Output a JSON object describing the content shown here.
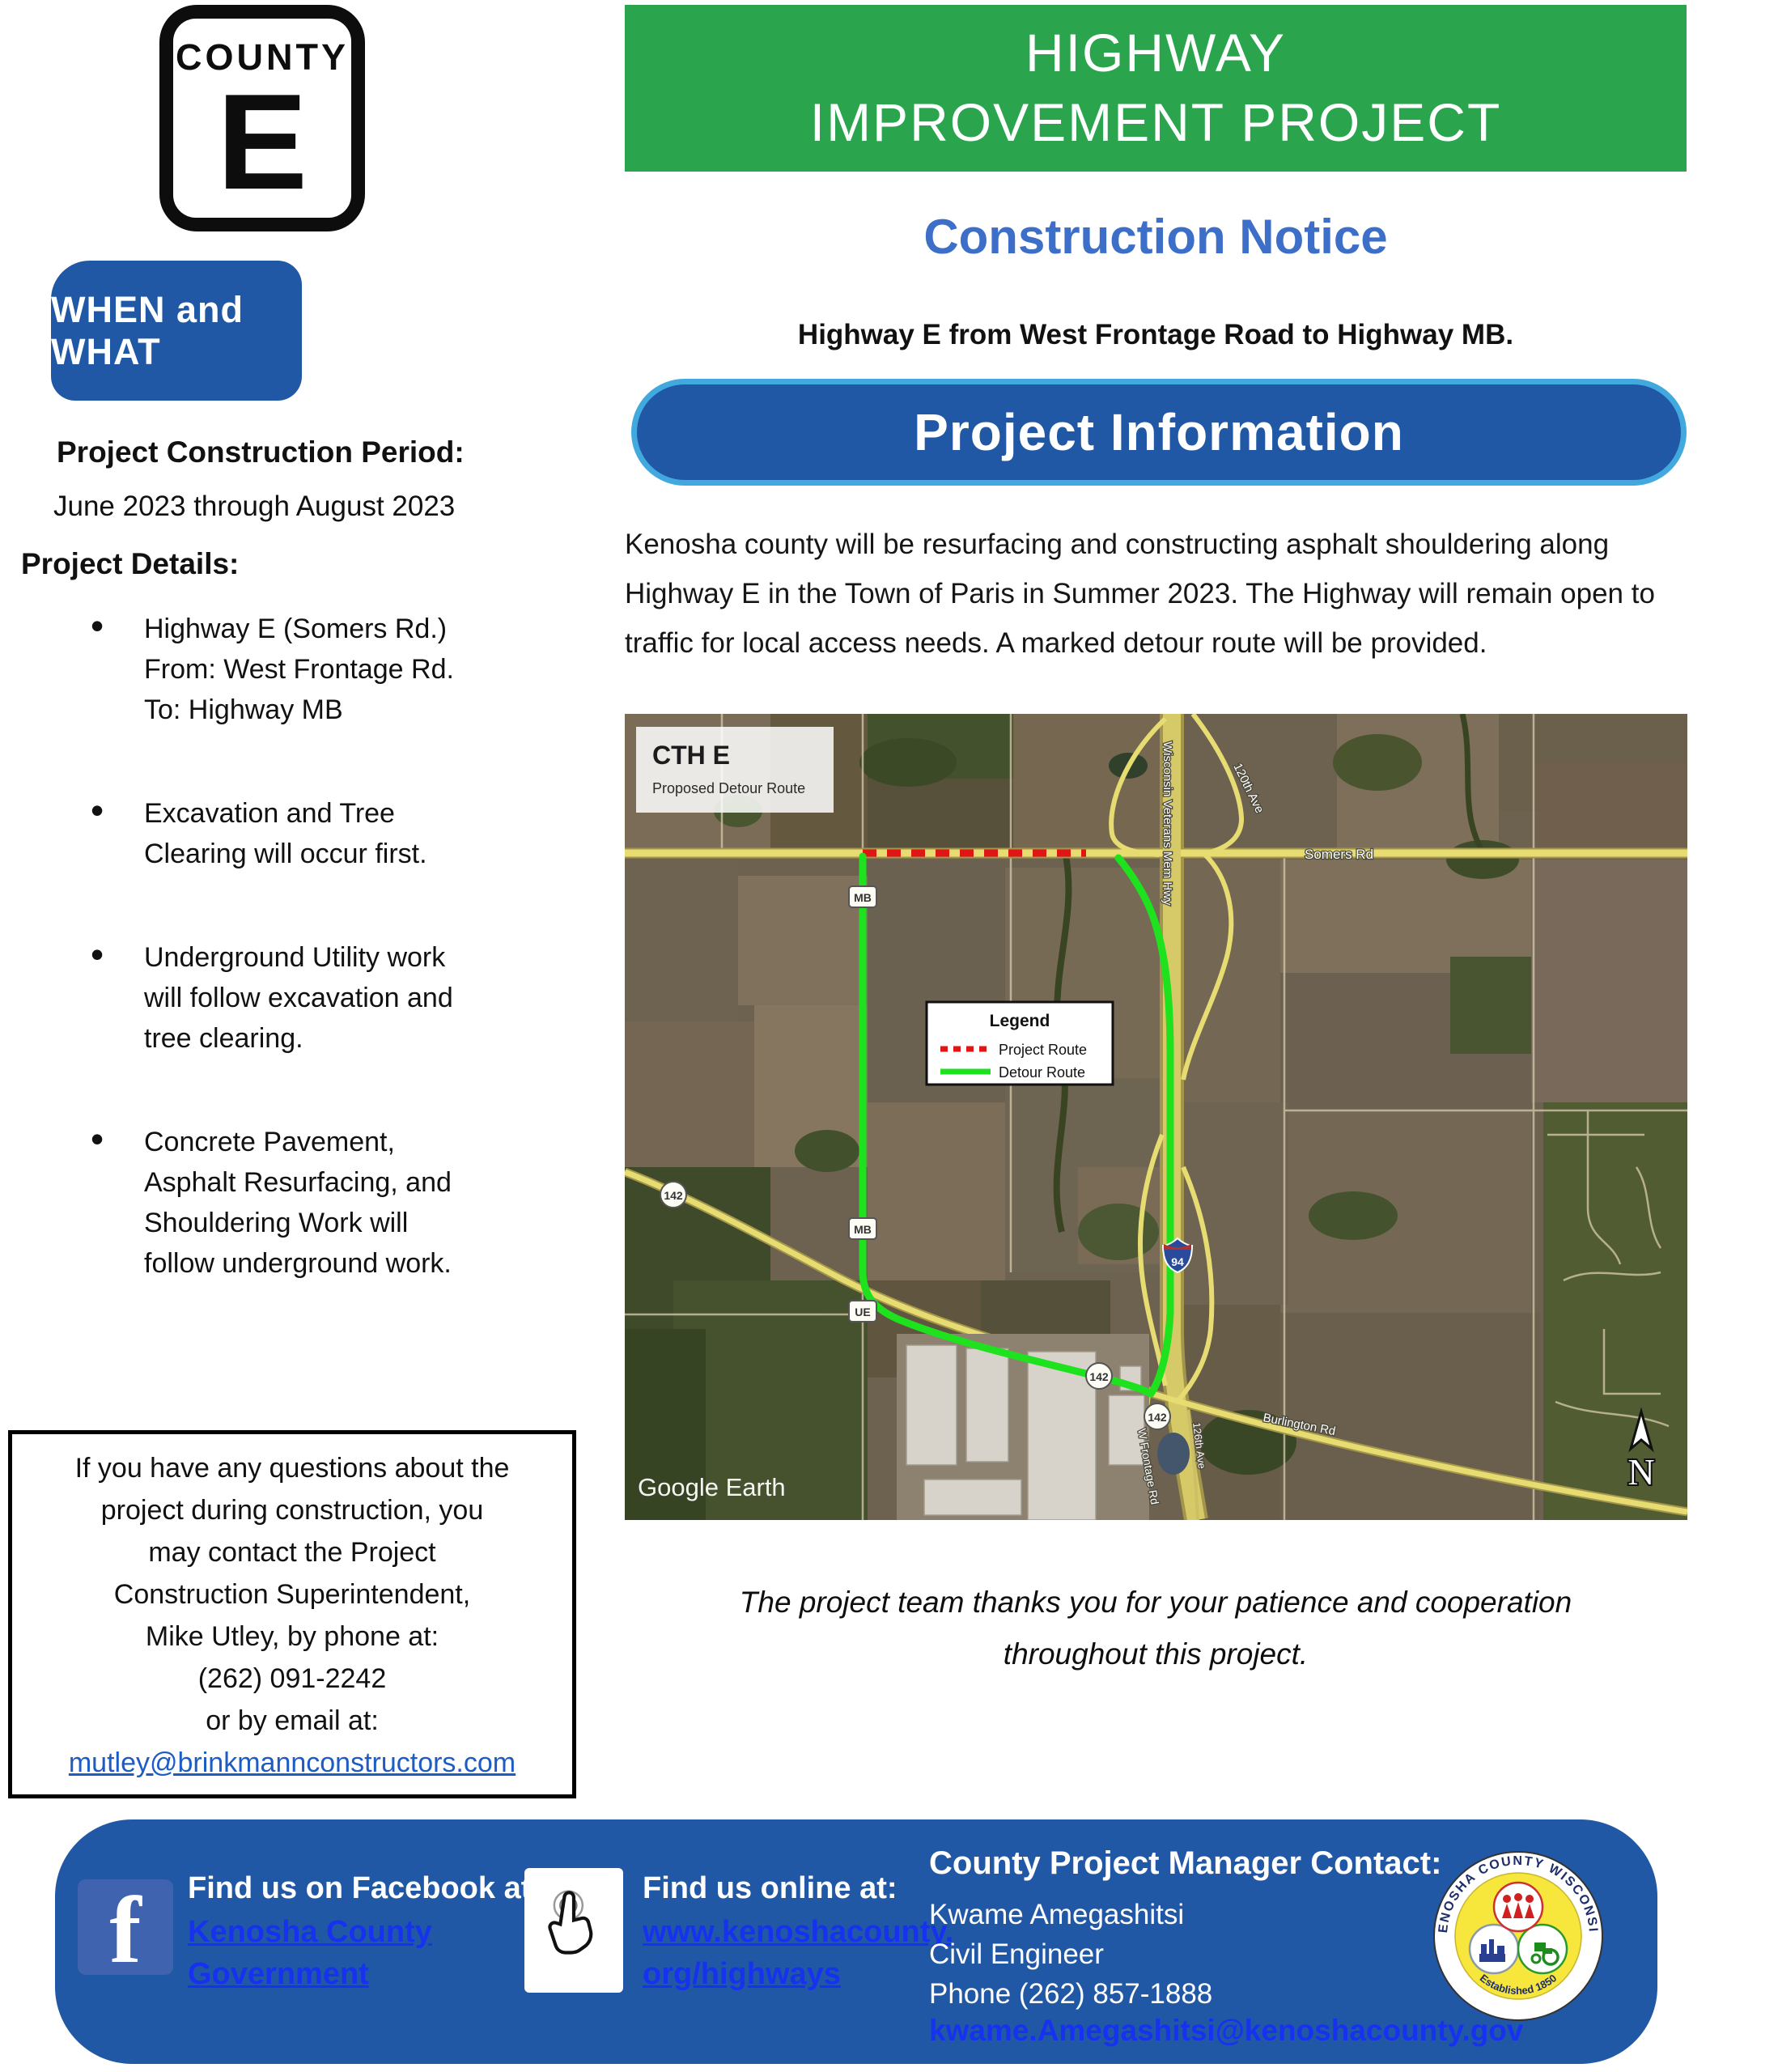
{
  "colors": {
    "blue": "#2158a6",
    "green": "#2aa44d",
    "notice": "#3e6fc8",
    "pillborder": "#41a9dd",
    "linkbright": "#1632ef",
    "linkmail": "#1d5cc4",
    "fbicon": "#3f63ae"
  },
  "county_sign": {
    "word": "COUNTY",
    "letter": "E"
  },
  "when_what": {
    "label": "WHEN and WHAT"
  },
  "left": {
    "period_heading": "Project Construction Period:",
    "period_value": "June 2023 through August 2023",
    "details_heading": "Project Details:",
    "bullets": [
      {
        "lines": [
          "Highway E (Somers Rd.)",
          "From: West Frontage Rd.",
          "To: Highway MB"
        ]
      },
      {
        "lines": [
          "Excavation and Tree",
          "Clearing will occur first."
        ]
      },
      {
        "lines": [
          "Underground Utility work",
          "will follow excavation and",
          "tree clearing."
        ]
      },
      {
        "lines": [
          "Concrete Pavement,",
          "Asphalt Resurfacing, and",
          "Shouldering Work will",
          "follow underground work."
        ]
      }
    ],
    "contact": {
      "lines": [
        "If you have any questions about the",
        "project during construction, you",
        "may contact the Project",
        "Construction Superintendent,",
        "Mike Utley, by phone at:",
        "(262) 091-2242",
        "or by email at:"
      ],
      "email": "mutley@brinkmannconstructors.com"
    }
  },
  "right": {
    "banner_line1": "HIGHWAY",
    "banner_line2": "IMPROVEMENT PROJECT",
    "notice_title": "Construction Notice",
    "subtitle": "Highway E from West Frontage Road to Highway MB.",
    "info_banner": "Project Information",
    "paragraph": "Kenosha county will be resurfacing and constructing asphalt shouldering along Highway E in the Town of Paris in Summer 2023. The Highway will remain open to traffic for local access needs. A marked detour route will be provided.",
    "thanks_line1": "The project team thanks you for your  patience and cooperation",
    "thanks_line2": "throughout this project."
  },
  "map": {
    "title": "CTH E",
    "subtitle": "Proposed Detour Route",
    "legend": {
      "title": "Legend",
      "items": [
        {
          "label": "Project Route",
          "color": "#e01616",
          "style": "dashed"
        },
        {
          "label": "Detour Route",
          "color": "#1de21d",
          "style": "solid"
        }
      ]
    },
    "labels": {
      "somers": "Somers Rd",
      "veterans": "Wisconsin Veterans Mem Hwy",
      "ave120": "120th Ave",
      "burlington": "Burlington Rd",
      "frontage": "W Frontage Rd",
      "ave126": "126th Ave",
      "watermark": "Google Earth",
      "north": "N"
    },
    "shields": {
      "mb": "MB",
      "ue": "UE",
      "r142": "142",
      "i94": "94"
    }
  },
  "footer": {
    "facebook_heading": "Find us on Facebook at:",
    "facebook_link1": "Kenosha County",
    "facebook_link2": "Government",
    "facebook_icon_letter": "f",
    "online_heading": "Find us online at:",
    "online_link1": "www.kenoshacounty.",
    "online_link2": "org/highways",
    "manager_heading": "County Project Manager Contact:",
    "manager_name": "Kwame Amegashitsi",
    "manager_title": "Civil Engineer",
    "manager_phone": "Phone (262) 857-1888",
    "manager_email": "kwame.Amegashitsi@kenoshacounty.gov",
    "seal_top": "KENOSHA COUNTY WISCONSIN",
    "seal_bottom": "Established 1850"
  }
}
